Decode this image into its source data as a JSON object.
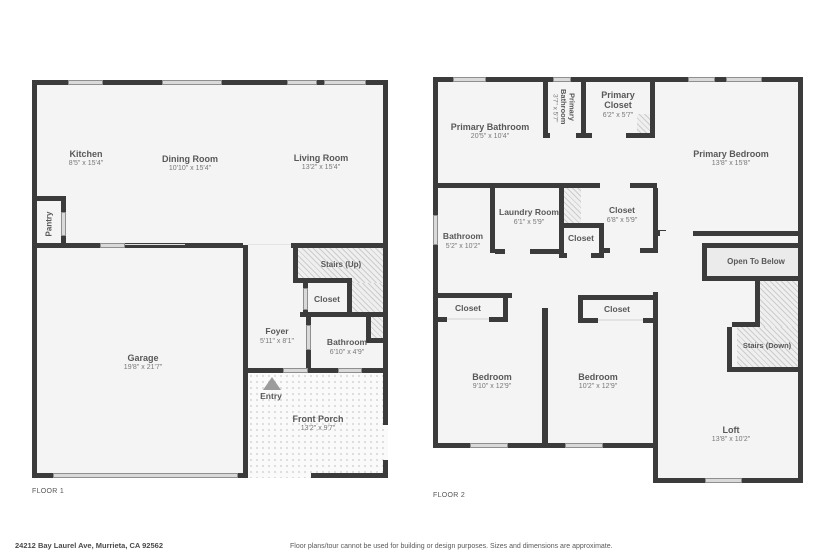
{
  "colors": {
    "wall": "#3b3b3b",
    "room_fill": "#f4f4f4",
    "window_marker": "#d9d9d9",
    "open_to_below_fill": "#ebebeb",
    "label_text": "#585858"
  },
  "floor1": {
    "label": "FLOOR 1",
    "rooms": {
      "kitchen": {
        "name": "Kitchen",
        "dims": "8'5\" x 15'4\""
      },
      "dining_room": {
        "name": "Dining Room",
        "dims": "10'10\" x 15'4\""
      },
      "living_room": {
        "name": "Living Room",
        "dims": "13'2\" x 15'4\""
      },
      "pantry": {
        "name": "Pantry"
      },
      "garage": {
        "name": "Garage",
        "dims": "19'8\" x 21'7\""
      },
      "stairs_up": {
        "name": "Stairs (Up)"
      },
      "closet": {
        "name": "Closet"
      },
      "foyer": {
        "name": "Foyer",
        "dims": "5'11\" x 8'1\""
      },
      "bathroom": {
        "name": "Bathroom",
        "dims": "6'10\" x 4'9\""
      },
      "entry": {
        "name": "Entry"
      },
      "front_porch": {
        "name": "Front Porch",
        "dims": "13'2\" x 9'7\""
      }
    }
  },
  "floor2": {
    "label": "FLOOR 2",
    "rooms": {
      "primary_bathroom": {
        "name": "Primary Bathroom",
        "dims": "20'5\" x 10'4\""
      },
      "primary_bathroom_small": {
        "name": "Primary Bathroom",
        "dims": "3'7\" x 5'7\""
      },
      "primary_closet": {
        "name": "Primary Closet",
        "dims": "6'2\" x 5'7\""
      },
      "primary_bedroom": {
        "name": "Primary Bedroom",
        "dims": "13'8\" x 15'8\""
      },
      "laundry_room": {
        "name": "Laundry Room",
        "dims": "6'1\" x 5'9\""
      },
      "bathroom": {
        "name": "Bathroom",
        "dims": "5'2\" x 10'2\""
      },
      "closet_mid": {
        "name": "Closet"
      },
      "closet_right": {
        "name": "Closet",
        "dims": "6'8\" x 5'9\""
      },
      "open_to_below": {
        "name": "Open To Below"
      },
      "stairs_down": {
        "name": "Stairs (Down)"
      },
      "closet_bed1": {
        "name": "Closet"
      },
      "closet_bed2": {
        "name": "Closet"
      },
      "bedroom1": {
        "name": "Bedroom",
        "dims": "9'10\" x 12'9\""
      },
      "bedroom2": {
        "name": "Bedroom",
        "dims": "10'2\" x 12'9\""
      },
      "loft": {
        "name": "Loft",
        "dims": "13'8\" x 10'2\""
      }
    }
  },
  "footer": {
    "address": "24212 Bay Laurel Ave, Murrieta, CA 92562",
    "disclaimer": "Floor plans/tour cannot be used for building or design purposes. Sizes and dimensions are approximate."
  }
}
